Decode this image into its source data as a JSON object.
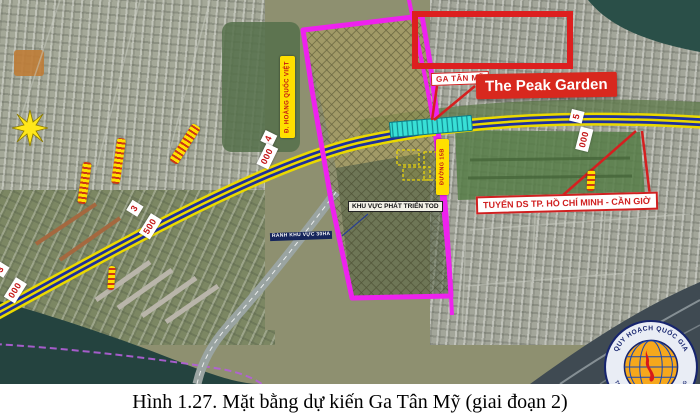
{
  "figure": {
    "caption": "Hình 1.27. Mặt bằng dự kiến Ga Tân Mỹ (giai đoạn 2)"
  },
  "map": {
    "station_label": "GA TÂN MỸ",
    "development_label": "The Peak Garden",
    "rail_line_label": "TUYẾN DS TP. HỒ CHÍ MINH - CẦN GIỜ",
    "tod_zone_label": "KHU VỰC PHÁT TRIỂN TOD",
    "boundary_label": "RANH KHU VỰC 30HA",
    "road_label_15b": "ĐƯỜNG 15B",
    "road_label_hoang_quoc_viet": "Đ. HOÀNG QUỐC VIỆT",
    "chainage_markers": [
      {
        "text": "3"
      },
      {
        "text": "000"
      },
      {
        "text": "3"
      },
      {
        "text": "500"
      },
      {
        "text": "4"
      },
      {
        "text": "000"
      },
      {
        "text": "5"
      },
      {
        "text": "000"
      }
    ],
    "colors": {
      "tod_boundary": "#EE22EE",
      "road_yellow": "#EAD900",
      "road_blue": "#1D2F9E",
      "station_cyan": "#38E0D6",
      "highlight_red": "#D8281E",
      "marker_yellow": "#FFDF00"
    }
  },
  "logo": {
    "arc_top": "QUY HOẠCH QUỐC GIA",
    "arc_bottom": "TRUNG TÂM QUY HOẠCH HẠ TẦNG"
  }
}
